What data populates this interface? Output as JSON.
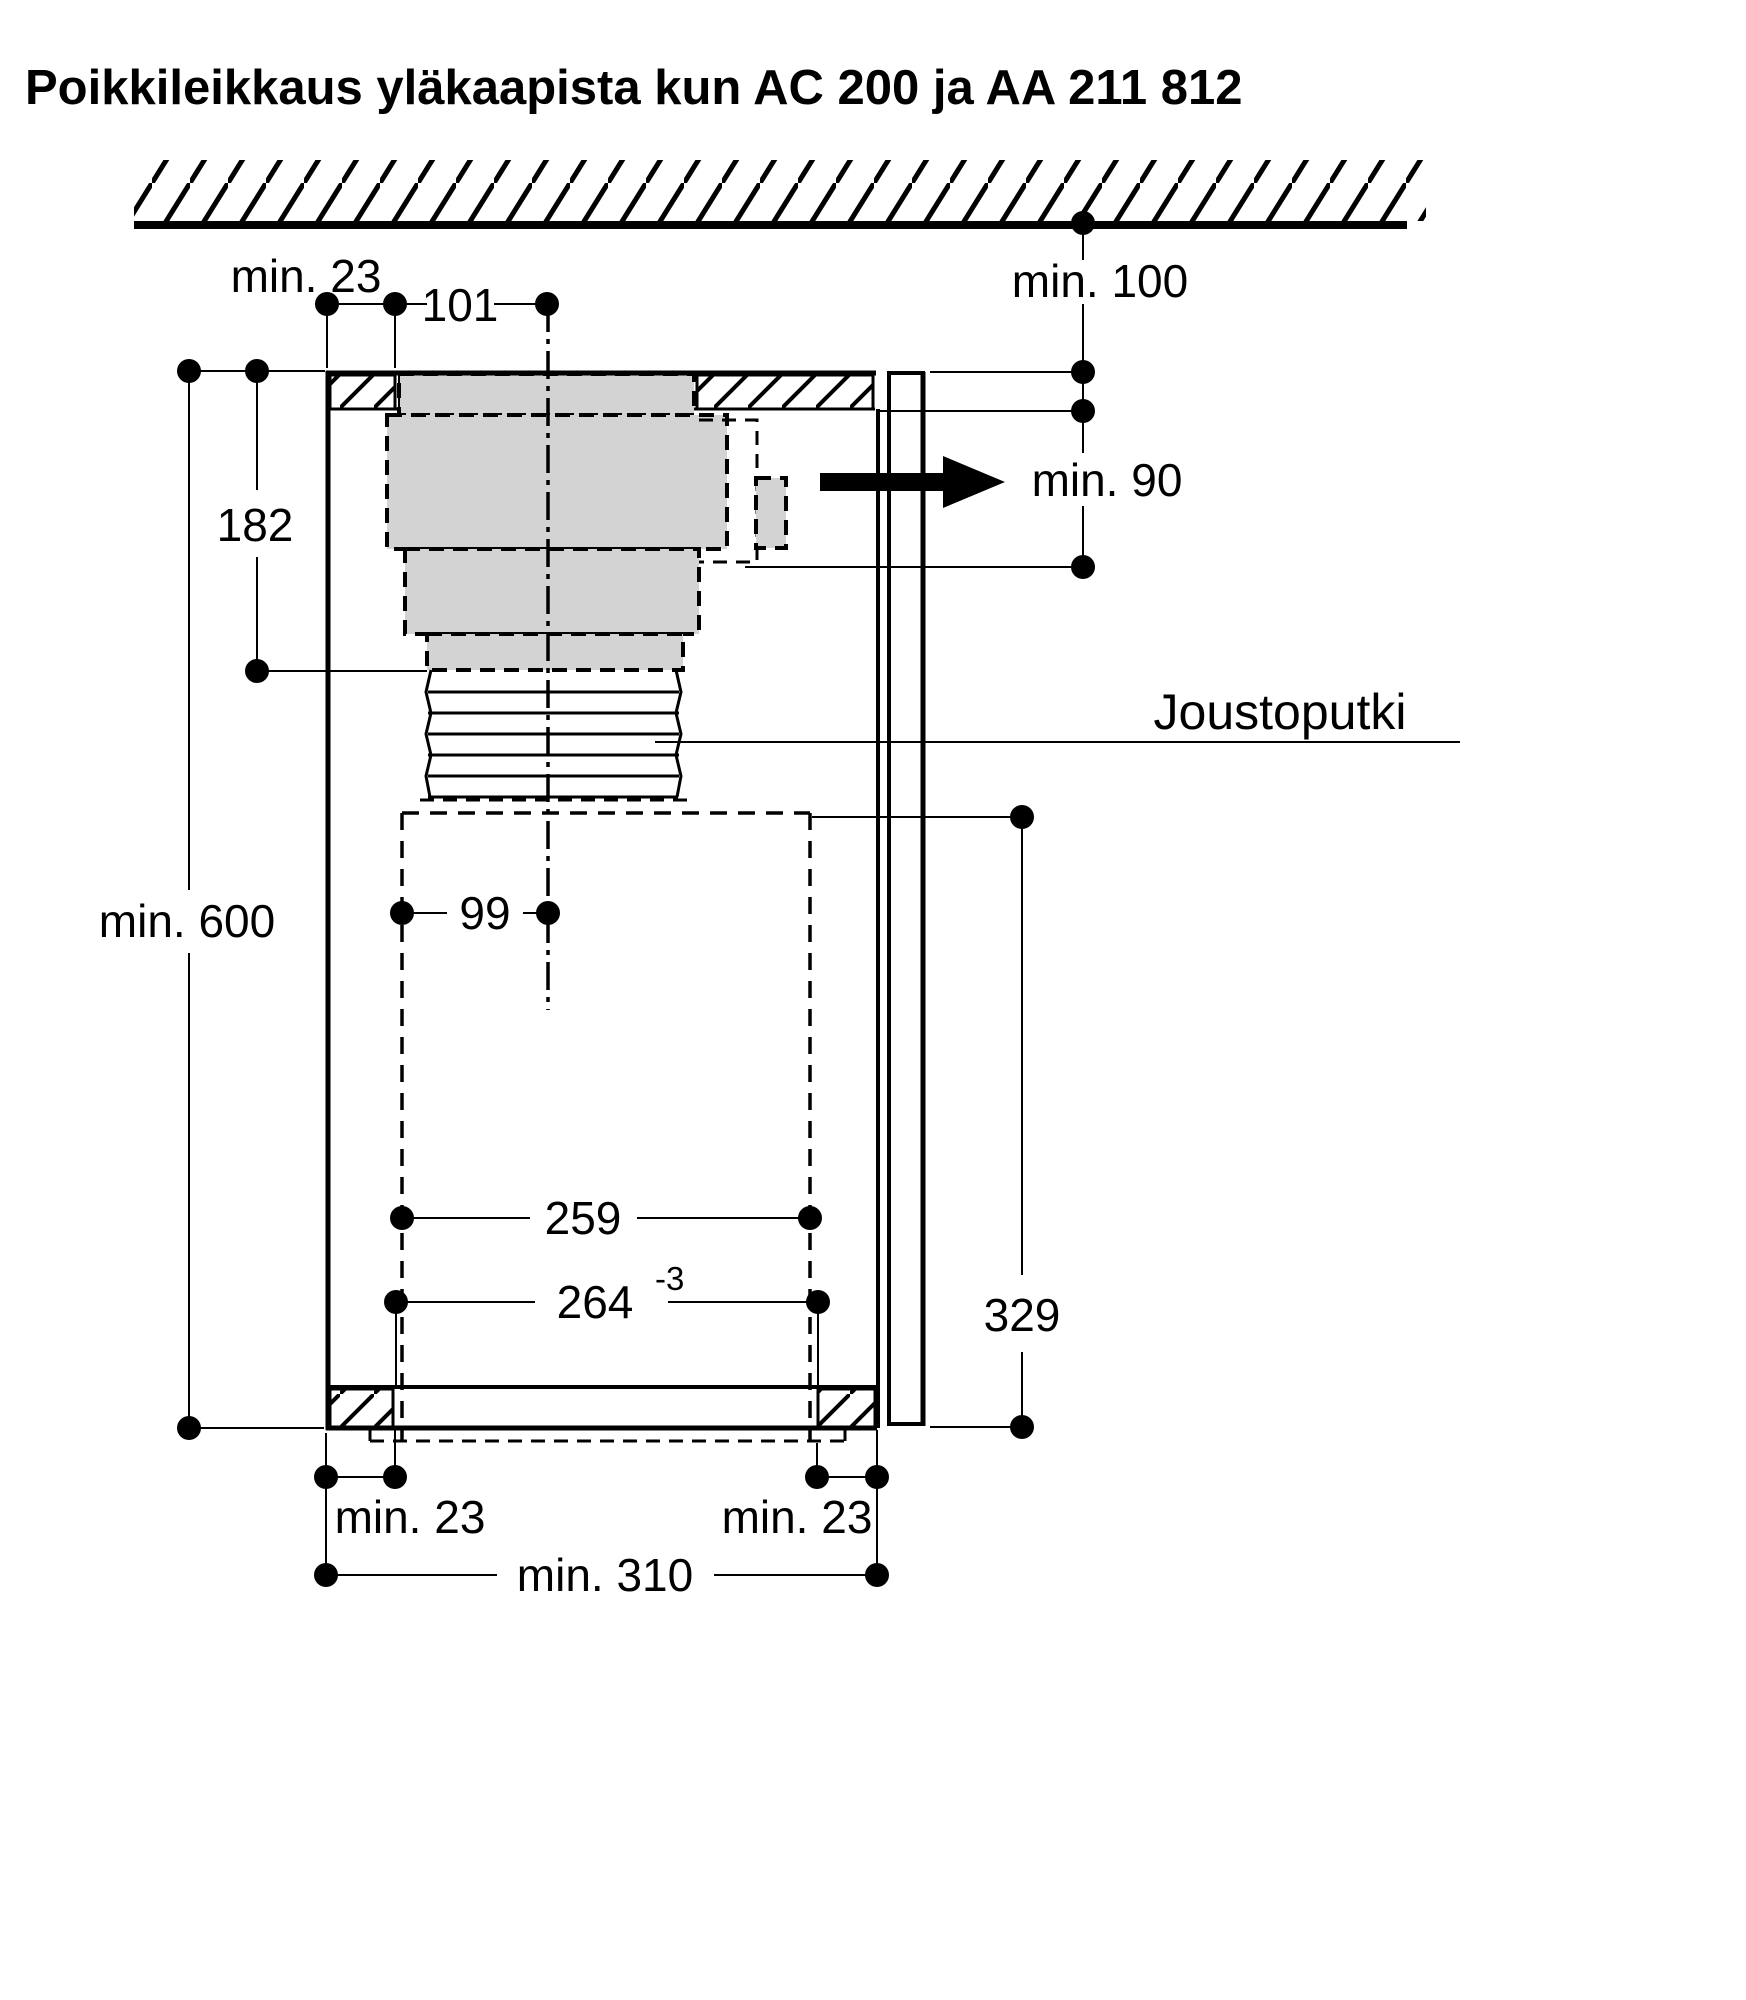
{
  "title": "Poikkileikkaus yläkaapista kun AC 200 ja AA 211 812",
  "colors": {
    "line": "#000000",
    "duct_fill": "#d3d3d3",
    "background": "#ffffff"
  },
  "labels": {
    "top_left_gap": "min. 23",
    "duct_centre_offset": "101",
    "ceiling_clearance": "min. 100",
    "outlet_opening_height": "min. 90",
    "duct_section_height": "182",
    "cabinet_height": "min. 600",
    "flexible_tube_callout": "Joustoputki",
    "recess_centre_offset": "99",
    "recess_height": "329",
    "recess_inner_width": "259",
    "cutout_width": "264",
    "cutout_tolerance": "-3",
    "bottom_left_gap": "min. 23",
    "bottom_right_gap": "min. 23",
    "bottom_min_width": "min. 310"
  }
}
